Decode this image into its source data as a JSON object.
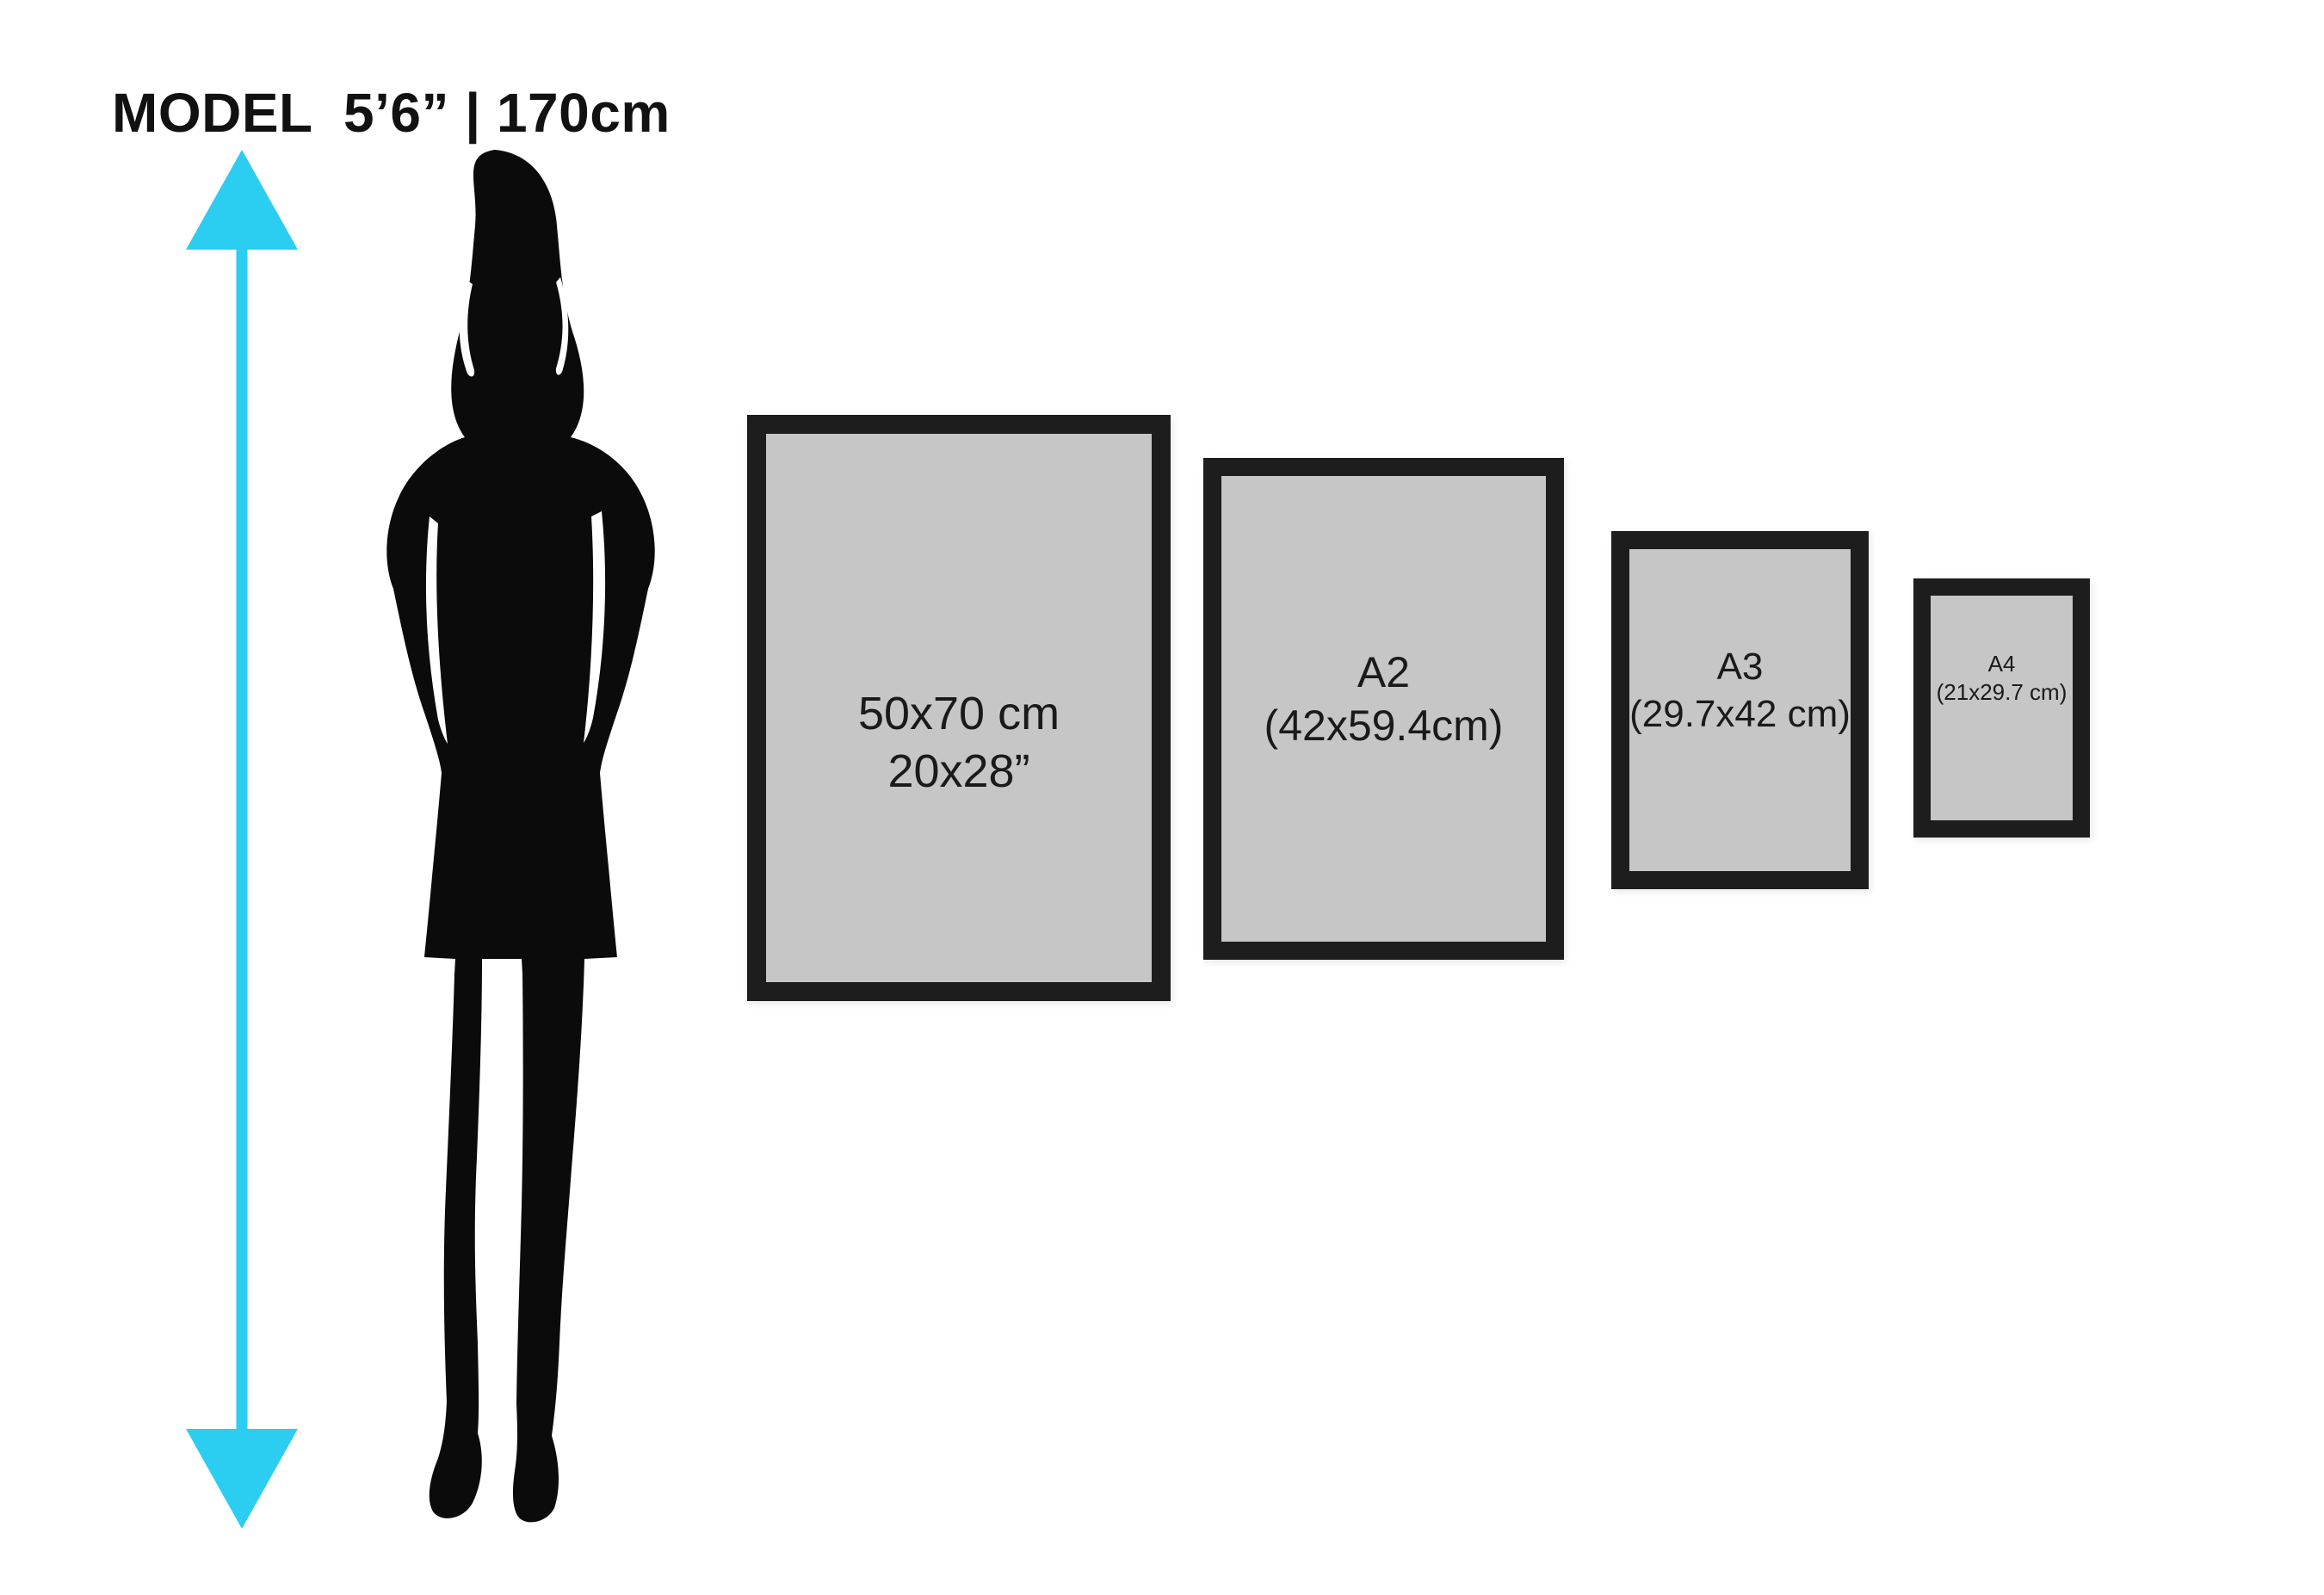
{
  "title": {
    "text": "MODEL  5’6” | 170cm"
  },
  "frames": [
    {
      "name": "frame-50x70",
      "line1": "50x70 cm",
      "line2": "20x28”"
    },
    {
      "name": "frame-a2",
      "line1": "A2",
      "line2": "(42x59.4cm)"
    },
    {
      "name": "frame-a3",
      "line1": "A3",
      "line2": "(29.7x42 cm)"
    },
    {
      "name": "frame-a4",
      "line1": "A4",
      "line2": "(21x29.7 cm)"
    }
  ],
  "colors": {
    "background": "#ffffff",
    "title_text": "#111111",
    "frame_border": "#1d1d1d",
    "frame_matte": "#c6c6c6",
    "label_text": "#1a1a1a",
    "arrow": "#2bcdf1",
    "silhouette": "#0b0b0b"
  }
}
